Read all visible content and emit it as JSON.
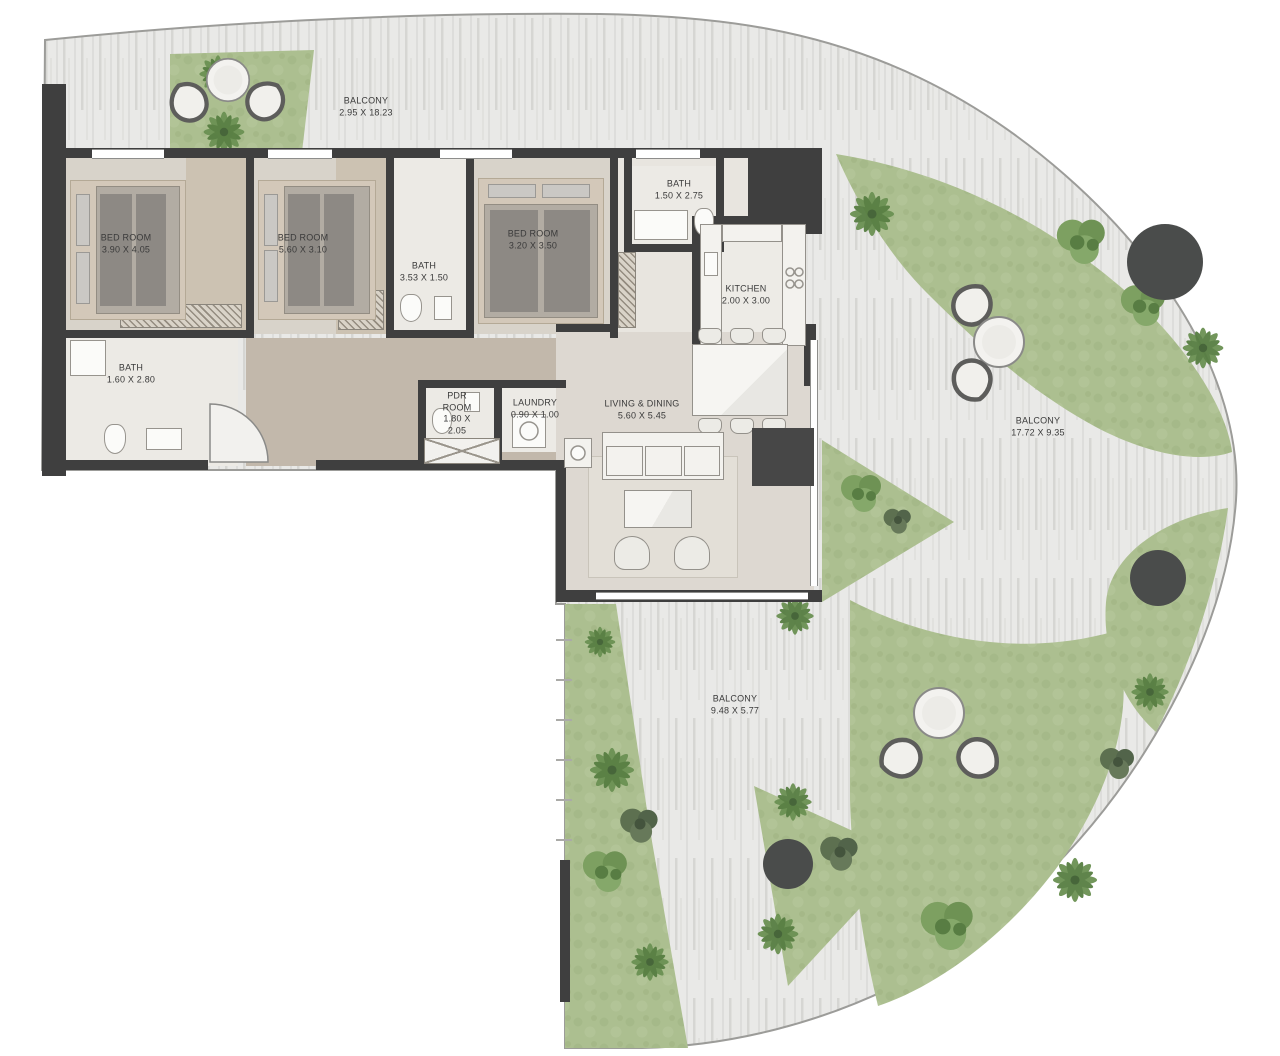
{
  "plan": {
    "type": "apartment-floor-plan",
    "rooms": [
      {
        "id": "balcony-top",
        "name": "BALCONY",
        "dims": "2.95 X 18.23",
        "x": 366,
        "y": 107
      },
      {
        "id": "bedroom-1",
        "name": "BED ROOM",
        "dims": "3.90 X 4.05",
        "x": 126,
        "y": 244
      },
      {
        "id": "bedroom-2",
        "name": "BED ROOM",
        "dims": "5.60 X 3.10",
        "x": 303,
        "y": 244
      },
      {
        "id": "bath-2",
        "name": "BATH",
        "dims": "3.53 X 1.50",
        "x": 424,
        "y": 272
      },
      {
        "id": "bedroom-3",
        "name": "BED ROOM",
        "dims": "3.20 X 3.50",
        "x": 533,
        "y": 240
      },
      {
        "id": "bath-3",
        "name": "BATH",
        "dims": "1.50 X 2.75",
        "x": 679,
        "y": 190
      },
      {
        "id": "kitchen",
        "name": "KITCHEN",
        "dims": "2.00 X 3.00",
        "x": 746,
        "y": 295
      },
      {
        "id": "bath-1",
        "name": "BATH",
        "dims": "1.60 X 2.80",
        "x": 131,
        "y": 374
      },
      {
        "id": "pdr-room",
        "name": "PDR ROOM",
        "dims": "1.80 X 2.05",
        "x": 457,
        "y": 414,
        "wrap": true,
        "w": 46
      },
      {
        "id": "laundry",
        "name": "LAUNDRY",
        "dims": "0.90 X 1.00",
        "x": 535,
        "y": 409
      },
      {
        "id": "living-dining",
        "name": "LIVING & DINING",
        "dims": "5.60 X 5.45",
        "x": 642,
        "y": 410
      },
      {
        "id": "balcony-right",
        "name": "BALCONY",
        "dims": "17.72 X 9.35",
        "x": 1038,
        "y": 427
      },
      {
        "id": "balcony-bottom",
        "name": "BALCONY",
        "dims": "9.48 X 5.77",
        "x": 735,
        "y": 705
      }
    ],
    "colors": {
      "wall": "#3f3f3f",
      "deck": "#e9e9e7",
      "grass": "#acbf90",
      "corridor": "#c2b8ab",
      "bedroom_floor": "#d8d3ca",
      "tile_floor": "#eceae5",
      "dark_feature": "#4a4c4b",
      "outline": "#9c9c99"
    }
  }
}
